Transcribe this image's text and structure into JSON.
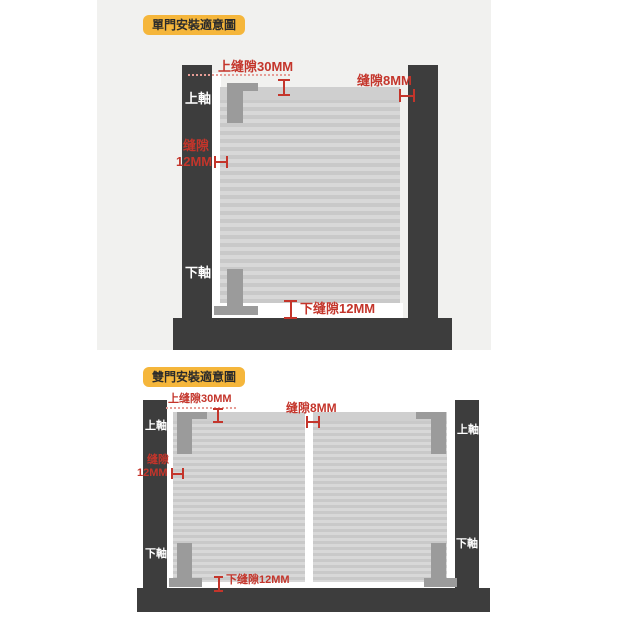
{
  "colors": {
    "accent_red": "#c4352b",
    "badge_bg": "#f5b63b",
    "badge_text": "#2b2b2b",
    "pillar": "#3d3d3d",
    "door_stripe_light": "#d8d8d8",
    "door_stripe_dark": "#c9c9c9",
    "hinge": "#9b9b9b",
    "panel_bg": "#f1f1ef",
    "axis_text": "#ffffff",
    "dotted_line": "#e69d96"
  },
  "icons": {
    "vertical_gap_mark": "i-beam-mark",
    "horizontal_gap_mark": "h-bar-mark"
  },
  "single": {
    "badge": "單門安裝適意圖",
    "top_gap_label": "上缝隙30MM",
    "right_gap_label": "缝隙8MM",
    "left_gap_label_line1": "缝隙",
    "left_gap_label_line2": "12MM",
    "bottom_gap_label": "下缝隙12MM",
    "upper_axis_label": "上軸",
    "lower_axis_label": "下軸"
  },
  "double": {
    "badge": "雙門安裝適意圖",
    "top_gap_label": "上缝隙30MM",
    "center_gap_label": "缝隙8MM",
    "left_gap_label_line1": "缝隙",
    "left_gap_label_line2": "12MM",
    "bottom_gap_label": "下缝隙12MM",
    "left_upper_axis_label": "上軸",
    "left_lower_axis_label": "下軸",
    "right_upper_axis_label": "上軸",
    "right_lower_axis_label": "下軸"
  }
}
